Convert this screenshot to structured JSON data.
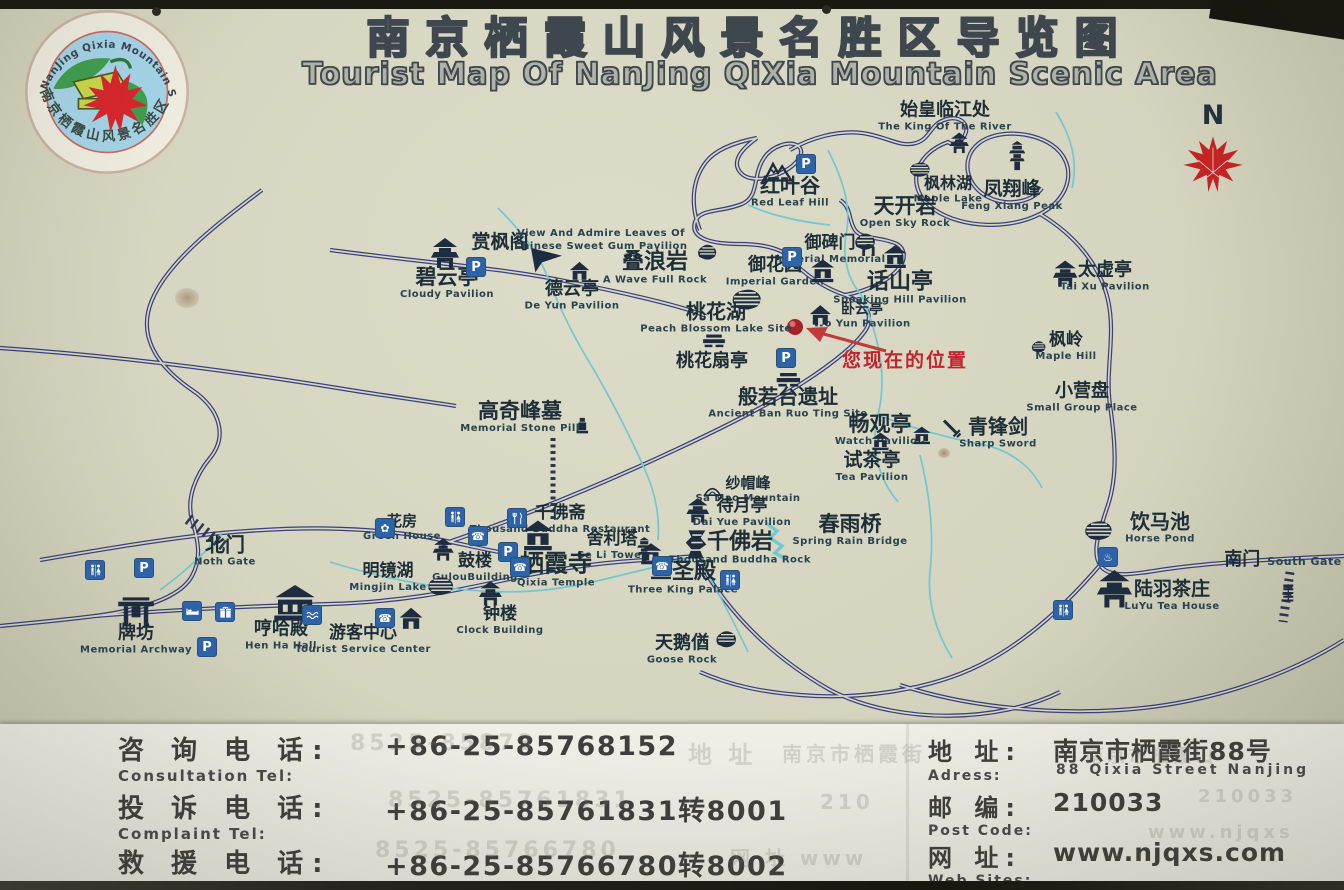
{
  "title": {
    "cn": "南京栖霞山风景名胜区导览图",
    "en": "Tourist Map Of NanJing QiXia Mountain Scenic Area"
  },
  "logo": {
    "arc_top": "NanJing Qixia Mountain Scenic Area",
    "arc_bottom": "南京栖霞山风景名胜区"
  },
  "compass": {
    "label": "N"
  },
  "you_are_here": {
    "label": "您现在的位置"
  },
  "colors": {
    "board": "#d4d4bf",
    "road": "#3a3f7d",
    "stream": "#72c7d0",
    "service_blue": "#2e63a8",
    "marker_red": "#c4232e",
    "leaf_red": "#c32322"
  },
  "map": {
    "locations": [
      {
        "cn": "始皇临江处",
        "en": "The King Of The River",
        "x": 945,
        "y": 117,
        "size": 18,
        "icon": "pavilion",
        "isz": 22,
        "ix": 14,
        "iy": 27
      },
      {
        "cn": "红叶谷",
        "en": "Red Leaf Hill",
        "x": 790,
        "y": 192,
        "size": 20,
        "icon": "mountain",
        "isz": 30,
        "ix": -12,
        "iy": -22
      },
      {
        "cn": "枫林湖",
        "en": "Maple Lake",
        "x": 948,
        "y": 190,
        "size": 16,
        "icon": "lake",
        "isz": 24,
        "ix": -28,
        "iy": -20
      },
      {
        "cn": "凤翔峰",
        "en": "Feng Xiang Peak",
        "x": 1012,
        "y": 196,
        "size": 19,
        "icon": "tower",
        "isz": 30,
        "ix": 5,
        "iy": -40
      },
      {
        "cn": "天开岩",
        "en": "Open Sky Rock",
        "x": 905,
        "y": 212,
        "size": 21,
        "icon": "rock",
        "isz": 26,
        "ix": -40,
        "iy": 30
      },
      {
        "cn": "赏枫阁",
        "en": "",
        "x": 500,
        "y": 243,
        "size": 19,
        "icon": "flag",
        "isz": 40,
        "ix": 46,
        "iy": 16
      },
      {
        "cn": "",
        "en": "View And Admire Leaves Of Chinese Sweet Gum Pavilion",
        "x": 601,
        "y": 240,
        "w": 175
      },
      {
        "cn": "碧云亭",
        "en": "Cloudy Pavilion",
        "x": 447,
        "y": 283,
        "size": 21,
        "icon": "pavilion",
        "isz": 32,
        "ix": -2,
        "iy": -29
      },
      {
        "cn": "德云亭",
        "en": "De Yun Pavilion",
        "x": 572,
        "y": 296,
        "size": 18,
        "icon": "house",
        "isz": 22,
        "ix": 8,
        "iy": -24
      },
      {
        "cn": "叠浪岩",
        "en": "A Wave Full Rock",
        "x": 655,
        "y": 268,
        "size": 22,
        "icon": "rock",
        "isz": 24,
        "ix": 52,
        "iy": -16
      },
      {
        "cn": "御碑门",
        "en": "Imperial Memorial",
        "x": 830,
        "y": 250,
        "size": 17,
        "icon": "arch",
        "isz": 18,
        "ix": 38,
        "iy": -2
      },
      {
        "cn": "御花园",
        "en": "Imperial Garden",
        "x": 775,
        "y": 272,
        "size": 18,
        "icon": "temple",
        "isz": 26,
        "ix": 48,
        "iy": 0
      },
      {
        "cn": "话山亭",
        "en": "Speaking Hill Pavilion",
        "x": 900,
        "y": 288,
        "size": 22,
        "icon": "temple",
        "isz": 26,
        "ix": -5,
        "iy": -31
      },
      {
        "cn": "卧云亭",
        "en": "Wo Yun Pavilion",
        "x": 862,
        "y": 316,
        "size": 14,
        "icon": "house",
        "isz": 24,
        "ix": -42,
        "iy": 0
      },
      {
        "cn": "桃花湖",
        "en": "Peach Blossom Lake Site",
        "x": 716,
        "y": 318,
        "size": 20,
        "icon": "lake",
        "isz": 34,
        "ix": 30,
        "iy": -19
      },
      {
        "cn": "桃花扇亭",
        "en": "",
        "x": 712,
        "y": 362,
        "size": 18,
        "icon": "table",
        "isz": 28,
        "ix": 2,
        "iy": -20
      },
      {
        "cn": "太虚亭",
        "en": "Tai Xu Pavilion",
        "x": 1105,
        "y": 277,
        "size": 18,
        "icon": "pavilion",
        "isz": 28,
        "ix": -40,
        "iy": -2
      },
      {
        "cn": "枫岭",
        "en": "Maple Hill",
        "x": 1066,
        "y": 347,
        "size": 17,
        "icon": "rock",
        "isz": 18,
        "ix": -28,
        "iy": 0
      },
      {
        "cn": "小营盘",
        "en": "Small Group Place",
        "x": 1082,
        "y": 398,
        "size": 18
      },
      {
        "cn": "高奇峰墓",
        "en": "Memorial Stone Pill",
        "x": 520,
        "y": 417,
        "size": 21,
        "icon": "grave",
        "isz": 18,
        "ix": 62,
        "iy": 8
      },
      {
        "cn": "般若台遗址",
        "en": "Ancient Ban Ruo Ting Site",
        "x": 788,
        "y": 403,
        "size": 20,
        "icon": "table",
        "isz": 30,
        "ix": 0,
        "iy": -23
      },
      {
        "cn": "畅观亭",
        "en": "Watch Pavilion",
        "x": 880,
        "y": 430,
        "size": 21,
        "icon": "temple",
        "isz": 20,
        "ix": 42,
        "iy": 6
      },
      {
        "cn": "青锋剑",
        "en": "Sharp Sword",
        "x": 998,
        "y": 433,
        "size": 20,
        "icon": "sword",
        "isz": 22,
        "ix": -46,
        "iy": -4
      },
      {
        "cn": "试茶亭",
        "en": "Tea Pavilion",
        "x": 872,
        "y": 467,
        "size": 19,
        "icon": "temple",
        "isz": 20,
        "ix": 8,
        "iy": -25
      },
      {
        "cn": "纱帽峰",
        "en": "Sa Mao Mountain",
        "x": 748,
        "y": 490,
        "size": 15,
        "icon": "hill",
        "isz": 18,
        "ix": -36,
        "iy": 0
      },
      {
        "cn": "待月亭",
        "en": "Dai Yue Pavilion",
        "x": 742,
        "y": 513,
        "size": 17,
        "icon": "pavilion",
        "isz": 26,
        "ix": -44,
        "iy": -2
      },
      {
        "cn": "春雨桥",
        "en": "Spring Rain Bridge",
        "x": 850,
        "y": 530,
        "size": 21
      },
      {
        "cn": "千佛岩",
        "en": "Thousand Buddha Rock",
        "x": 740,
        "y": 548,
        "size": 22,
        "icon": "cliff",
        "isz": 30,
        "ix": -44,
        "iy": -4
      },
      {
        "cn": "千佛斋",
        "en": "Thousand Buddha Restaurant",
        "x": 560,
        "y": 520,
        "size": 17
      },
      {
        "cn": "舍利塔",
        "en": "Se Li Tower",
        "x": 612,
        "y": 546,
        "size": 17,
        "icon": "tower",
        "isz": 26,
        "ix": 32,
        "iy": 4
      },
      {
        "cn": "栖霞寺",
        "en": "Qixia Temple",
        "x": 556,
        "y": 570,
        "size": 24,
        "icon": "temple",
        "isz": 34,
        "ix": -18,
        "iy": -34
      },
      {
        "cn": "鼓楼",
        "en": "GulouBuilding",
        "x": 475,
        "y": 568,
        "size": 17,
        "icon": "pavilion",
        "isz": 24,
        "ix": -32,
        "iy": -18
      },
      {
        "cn": "明镜湖",
        "en": "Mingjin Lake",
        "x": 388,
        "y": 578,
        "size": 17,
        "icon": "lake",
        "isz": 30,
        "ix": 52,
        "iy": 8
      },
      {
        "cn": "三圣殿",
        "en": "Three King Palace",
        "x": 683,
        "y": 578,
        "size": 22,
        "icon": "temple",
        "isz": 24,
        "ix": -32,
        "iy": -24
      },
      {
        "cn": "钟楼",
        "en": "Clock Building",
        "x": 500,
        "y": 621,
        "size": 17,
        "icon": "pavilion",
        "isz": 26,
        "ix": -10,
        "iy": -27
      },
      {
        "cn": "天鹅偤",
        "en": "Goose Rock",
        "x": 682,
        "y": 650,
        "size": 18,
        "icon": "rock",
        "isz": 26,
        "ix": 44,
        "iy": -10
      },
      {
        "cn": "花房",
        "en": "Green House",
        "x": 402,
        "y": 528,
        "size": 15
      },
      {
        "cn": "北门",
        "en": "Noth Gate",
        "x": 225,
        "y": 551,
        "size": 20
      },
      {
        "cn": "牌坊",
        "en": "Memorial Archway",
        "x": 136,
        "y": 640,
        "size": 18,
        "icon": "archway",
        "isz": 40,
        "ix": 0,
        "iy": -30
      },
      {
        "cn": "哼哈殿",
        "en": "Hen Ha Hall",
        "x": 281,
        "y": 636,
        "size": 18,
        "icon": "bigtemple",
        "isz": 44,
        "ix": 14,
        "iy": -31
      },
      {
        "cn": "游客中心",
        "en": "Tourist Service Center",
        "x": 363,
        "y": 640,
        "size": 17,
        "icon": "house",
        "isz": 26,
        "ix": 48,
        "iy": -21
      },
      {
        "cn": "饮马池",
        "en": "Horse Pond",
        "x": 1160,
        "y": 528,
        "size": 20,
        "icon": "lake",
        "isz": 32,
        "ix": -62,
        "iy": 2
      },
      {
        "cn": "陆羽茶庄",
        "en": "LuYu Tea House",
        "x": 1172,
        "y": 596,
        "size": 19,
        "icon": "pavilion",
        "isz": 40,
        "ix": -58,
        "iy": -6
      },
      {
        "cn": "南门",
        "en": "South Gate",
        "x": 1283,
        "y": 560,
        "size": 18,
        "en_side": true,
        "icon": "steps",
        "isz": 20,
        "ix": 5,
        "iy": 33
      }
    ],
    "services": [
      {
        "type": "parking",
        "x": 806,
        "y": 164
      },
      {
        "type": "parking",
        "x": 792,
        "y": 257
      },
      {
        "type": "parking",
        "x": 476,
        "y": 267
      },
      {
        "type": "parking",
        "x": 786,
        "y": 358
      },
      {
        "type": "parking",
        "x": 144,
        "y": 568
      },
      {
        "type": "parking",
        "x": 207,
        "y": 647
      },
      {
        "type": "parking",
        "x": 508,
        "y": 552
      },
      {
        "type": "toilet",
        "x": 95,
        "y": 570
      },
      {
        "type": "toilet",
        "x": 455,
        "y": 517
      },
      {
        "type": "toilet",
        "x": 730,
        "y": 580
      },
      {
        "type": "toilet",
        "x": 1063,
        "y": 610
      },
      {
        "type": "phone",
        "x": 478,
        "y": 536
      },
      {
        "type": "phone",
        "x": 520,
        "y": 567
      },
      {
        "type": "phone",
        "x": 662,
        "y": 566
      },
      {
        "type": "phone",
        "x": 385,
        "y": 618
      },
      {
        "type": "restaurant",
        "x": 517,
        "y": 518
      },
      {
        "type": "flower",
        "x": 385,
        "y": 528
      },
      {
        "type": "fountain",
        "x": 1108,
        "y": 557
      },
      {
        "type": "bed",
        "x": 192,
        "y": 611
      },
      {
        "type": "gift",
        "x": 225,
        "y": 612
      },
      {
        "type": "wave",
        "x": 312,
        "y": 615
      }
    ]
  },
  "contact": {
    "rows": [
      {
        "cn": "咨 询 电 话:",
        "en": "Consultation Tel:",
        "value": "+86-25-85768152"
      },
      {
        "cn": "投 诉 电 话:",
        "en": "Complaint   Tel:",
        "value": "+86-25-85761831转8001"
      },
      {
        "cn": "救 援 电 话:",
        "en": "Tel:",
        "value": "+86-25-85766780转8002"
      }
    ],
    "info": [
      {
        "cn": "地 址:",
        "en": "Adress:",
        "value": "南京市栖霞街88号",
        "value_en": "88 Qixia Street Nanjing"
      },
      {
        "cn": "邮 编:",
        "en": "Post Code:",
        "value": "210033",
        "value_en": ""
      },
      {
        "cn": "网 址:",
        "en": "Web Sites:",
        "value": "www.njqxs.com",
        "value_en": ""
      }
    ]
  },
  "ghosts": [
    {
      "t": "8525-85873",
      "x": 350,
      "y": 731,
      "s": 22
    },
    {
      "t": "地 址",
      "x": 688,
      "y": 735,
      "s": 24
    },
    {
      "t": "南京市栖霞街",
      "x": 782,
      "y": 738,
      "s": 20
    },
    {
      "t": "8525-85761831",
      "x": 388,
      "y": 788,
      "s": 22
    },
    {
      "t": "210",
      "x": 820,
      "y": 790,
      "s": 20
    },
    {
      "t": "8525-85766780",
      "x": 375,
      "y": 838,
      "s": 22
    },
    {
      "t": "网 址  www",
      "x": 730,
      "y": 842,
      "s": 20
    },
    {
      "t": "南京市栖霞山",
      "x": 1085,
      "y": 742,
      "s": 18
    },
    {
      "t": "210033",
      "x": 1198,
      "y": 786,
      "s": 18
    },
    {
      "t": "www.njqxs",
      "x": 1148,
      "y": 822,
      "s": 18
    }
  ]
}
